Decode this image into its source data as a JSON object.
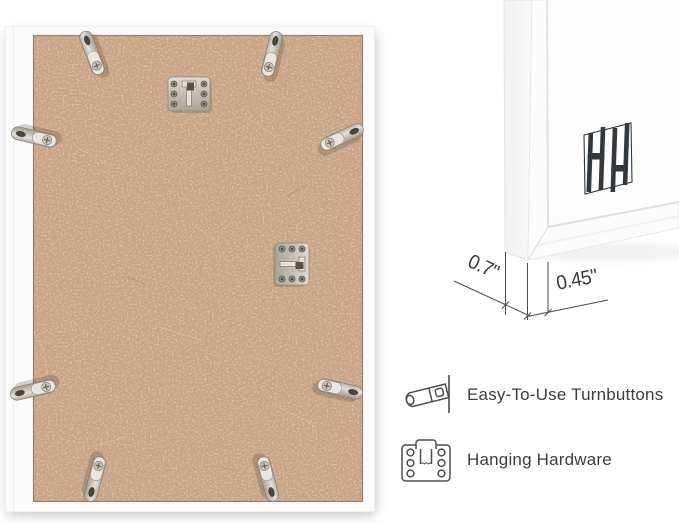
{
  "dimensions": {
    "depth": "0.7\"",
    "face_width": "0.45\""
  },
  "features": {
    "items": [
      {
        "icon": "turnbutton-icon",
        "label": "Easy-To-Use Turnbuttons"
      },
      {
        "icon": "hanging-hardware-icon",
        "label": "Hanging Hardware"
      }
    ]
  },
  "icons": {
    "brand_logo": "hh-frame-logo"
  },
  "colors": {
    "background": "#ffffff",
    "mdf_board": "#c8a385",
    "frame_white": "#fbfbfb",
    "hardware_silver": "#cfcbc4",
    "annotation_line": "#4a4a4a",
    "text": "#3e3e3e",
    "logo": "#34383b"
  }
}
